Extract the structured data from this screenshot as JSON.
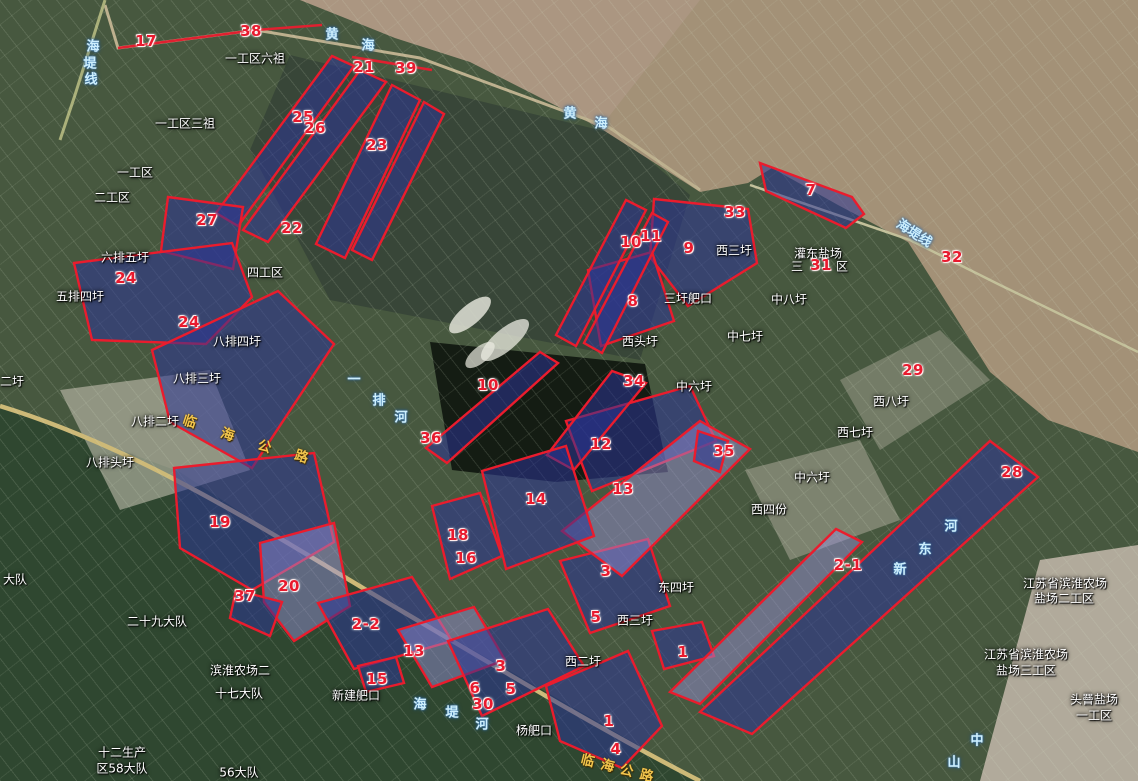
{
  "map_title": "satellite land-parcel annotation map",
  "colors": {
    "marker_red": "#e81a2e",
    "parcel_fill_blue": "#2c3496",
    "parcel_fill_lavender": "#968ed7",
    "parcel_stroke": "#ea1c2d",
    "place_text": "#ffffff",
    "water_text": "#cdeffd",
    "road_text": "#f2c54d",
    "sea": "#a39177",
    "farmland_dark": "#2f4730"
  },
  "markers": [
    {
      "label": "17",
      "x": 146,
      "y": 41
    },
    {
      "label": "38",
      "x": 251,
      "y": 31
    },
    {
      "label": "21",
      "x": 364,
      "y": 67
    },
    {
      "label": "39",
      "x": 406,
      "y": 68
    },
    {
      "label": "25",
      "x": 303,
      "y": 117
    },
    {
      "label": "26",
      "x": 315,
      "y": 128
    },
    {
      "label": "23",
      "x": 377,
      "y": 145
    },
    {
      "label": "27",
      "x": 207,
      "y": 220
    },
    {
      "label": "22",
      "x": 292,
      "y": 228
    },
    {
      "label": "24",
      "x": 126,
      "y": 278
    },
    {
      "label": "24",
      "x": 189,
      "y": 322
    },
    {
      "label": "10",
      "x": 631,
      "y": 242
    },
    {
      "label": "11",
      "x": 651,
      "y": 236
    },
    {
      "label": "9",
      "x": 689,
      "y": 248
    },
    {
      "label": "33",
      "x": 735,
      "y": 212
    },
    {
      "label": "7",
      "x": 811,
      "y": 190
    },
    {
      "label": "31",
      "x": 821,
      "y": 265
    },
    {
      "label": "32",
      "x": 952,
      "y": 257
    },
    {
      "label": "8",
      "x": 633,
      "y": 301
    },
    {
      "label": "34",
      "x": 634,
      "y": 381
    },
    {
      "label": "29",
      "x": 913,
      "y": 370
    },
    {
      "label": "10",
      "x": 488,
      "y": 385
    },
    {
      "label": "36",
      "x": 431,
      "y": 438
    },
    {
      "label": "12",
      "x": 601,
      "y": 444
    },
    {
      "label": "35",
      "x": 724,
      "y": 451
    },
    {
      "label": "13",
      "x": 623,
      "y": 489
    },
    {
      "label": "14",
      "x": 536,
      "y": 499
    },
    {
      "label": "18",
      "x": 458,
      "y": 535
    },
    {
      "label": "16",
      "x": 466,
      "y": 558
    },
    {
      "label": "28",
      "x": 1012,
      "y": 472
    },
    {
      "label": "19",
      "x": 220,
      "y": 522
    },
    {
      "label": "37",
      "x": 245,
      "y": 596
    },
    {
      "label": "20",
      "x": 289,
      "y": 586
    },
    {
      "label": "2-2",
      "x": 366,
      "y": 624
    },
    {
      "label": "13",
      "x": 414,
      "y": 651
    },
    {
      "label": "15",
      "x": 377,
      "y": 679
    },
    {
      "label": "3",
      "x": 606,
      "y": 571
    },
    {
      "label": "5",
      "x": 596,
      "y": 617
    },
    {
      "label": "3",
      "x": 501,
      "y": 666
    },
    {
      "label": "6",
      "x": 475,
      "y": 688
    },
    {
      "label": "5",
      "x": 511,
      "y": 689
    },
    {
      "label": "30",
      "x": 483,
      "y": 704
    },
    {
      "label": "1",
      "x": 683,
      "y": 652
    },
    {
      "label": "2-1",
      "x": 848,
      "y": 565
    },
    {
      "label": "1",
      "x": 609,
      "y": 721
    },
    {
      "label": "4",
      "x": 616,
      "y": 749
    }
  ],
  "place_labels": [
    {
      "text": "一工区六祖",
      "x": 255,
      "y": 58
    },
    {
      "text": "一工区三祖",
      "x": 185,
      "y": 123
    },
    {
      "text": "一工区",
      "x": 135,
      "y": 172
    },
    {
      "text": "二工区",
      "x": 112,
      "y": 197
    },
    {
      "text": "四工区",
      "x": 265,
      "y": 272
    },
    {
      "text": "六排五圩",
      "x": 125,
      "y": 257
    },
    {
      "text": "五排四圩",
      "x": 80,
      "y": 296
    },
    {
      "text": "八排四圩",
      "x": 237,
      "y": 341
    },
    {
      "text": "八排三圩",
      "x": 197,
      "y": 378
    },
    {
      "text": "八排二圩",
      "x": 155,
      "y": 421
    },
    {
      "text": "八排头圩",
      "x": 110,
      "y": 462
    },
    {
      "text": "二圩",
      "x": 12,
      "y": 381
    },
    {
      "text": "大队",
      "x": 15,
      "y": 579
    },
    {
      "text": "二十九大队",
      "x": 157,
      "y": 621
    },
    {
      "text": "滨淮农场二",
      "x": 240,
      "y": 670
    },
    {
      "text": "十七大队",
      "x": 239,
      "y": 693
    },
    {
      "text": "新建舥口",
      "x": 356,
      "y": 695
    },
    {
      "text": "56大队",
      "x": 239,
      "y": 772
    },
    {
      "text": "十二生产",
      "x": 122,
      "y": 752
    },
    {
      "text": "区58大队",
      "x": 122,
      "y": 768
    },
    {
      "text": "西三圩",
      "x": 734,
      "y": 250
    },
    {
      "text": "三圩舥口",
      "x": 688,
      "y": 298
    },
    {
      "text": "西头圩",
      "x": 640,
      "y": 341
    },
    {
      "text": "中八圩",
      "x": 789,
      "y": 299
    },
    {
      "text": "中七圩",
      "x": 745,
      "y": 336
    },
    {
      "text": "中六圩",
      "x": 694,
      "y": 386
    },
    {
      "text": "灌东盐场",
      "x": 818,
      "y": 253
    },
    {
      "text": "三",
      "x": 797,
      "y": 266
    },
    {
      "text": "区",
      "x": 842,
      "y": 266
    },
    {
      "text": "中六圩",
      "x": 812,
      "y": 477
    },
    {
      "text": "西四份",
      "x": 769,
      "y": 509
    },
    {
      "text": "西七圩",
      "x": 855,
      "y": 432
    },
    {
      "text": "西八圩",
      "x": 891,
      "y": 401
    },
    {
      "text": "东四圩",
      "x": 676,
      "y": 587
    },
    {
      "text": "西三圩",
      "x": 635,
      "y": 620
    },
    {
      "text": "西二圩",
      "x": 583,
      "y": 661
    },
    {
      "text": "杨舥口",
      "x": 534,
      "y": 730
    },
    {
      "text": "江苏省滨淮农场",
      "x": 1065,
      "y": 583
    },
    {
      "text": "盐场二工区",
      "x": 1064,
      "y": 598
    },
    {
      "text": "江苏省滨淮农场",
      "x": 1026,
      "y": 654
    },
    {
      "text": "盐场三工区",
      "x": 1026,
      "y": 670
    },
    {
      "text": "头罾盐场",
      "x": 1094,
      "y": 699
    },
    {
      "text": "一工区",
      "x": 1094,
      "y": 715
    }
  ],
  "water_labels": [
    {
      "text": "黄海",
      "chars": [
        {
          "c": "黄",
          "x": 332,
          "y": 33
        },
        {
          "c": "海",
          "x": 368,
          "y": 44
        }
      ]
    },
    {
      "text": "黄海",
      "chars": [
        {
          "c": "黄",
          "x": 570,
          "y": 112
        },
        {
          "c": "海",
          "x": 601,
          "y": 122
        }
      ]
    },
    {
      "text": "海堤线",
      "chars": [
        {
          "c": "海",
          "x": 93,
          "y": 45
        },
        {
          "c": "堤",
          "x": 90,
          "y": 62
        },
        {
          "c": "线",
          "x": 91,
          "y": 78
        }
      ]
    },
    {
      "text": "海堤线",
      "x": 915,
      "y": 232,
      "rot": 33
    },
    {
      "text": "一排河",
      "chars": [
        {
          "c": "一",
          "x": 354,
          "y": 378
        },
        {
          "c": "排",
          "x": 379,
          "y": 399
        },
        {
          "c": "河",
          "x": 401,
          "y": 416
        }
      ]
    },
    {
      "text": "海堤河",
      "chars": [
        {
          "c": "海",
          "x": 420,
          "y": 703
        },
        {
          "c": "堤",
          "x": 452,
          "y": 711
        },
        {
          "c": "河",
          "x": 482,
          "y": 723
        }
      ]
    },
    {
      "text": "新东河",
      "chars": [
        {
          "c": "河",
          "x": 951,
          "y": 525
        },
        {
          "c": "东",
          "x": 925,
          "y": 548
        },
        {
          "c": "新",
          "x": 900,
          "y": 568
        }
      ]
    },
    {
      "text": "中山",
      "chars": [
        {
          "c": "中",
          "x": 977,
          "y": 739
        },
        {
          "c": "山",
          "x": 954,
          "y": 761
        }
      ]
    }
  ],
  "road_labels": [
    {
      "text": "临海公路",
      "chars": [
        {
          "c": "临",
          "x": 190,
          "y": 420
        },
        {
          "c": "海",
          "x": 228,
          "y": 433
        },
        {
          "c": "公",
          "x": 265,
          "y": 445
        },
        {
          "c": "路",
          "x": 302,
          "y": 455
        }
      ],
      "rot": 18
    },
    {
      "text": "临海公路",
      "chars": [
        {
          "c": "临",
          "x": 588,
          "y": 759
        },
        {
          "c": "海",
          "x": 608,
          "y": 764
        },
        {
          "c": "公",
          "x": 627,
          "y": 769
        },
        {
          "c": "路",
          "x": 647,
          "y": 774
        }
      ],
      "rot": 14
    }
  ],
  "parcels": [
    {
      "points": "332,56 354,66 238,226 216,213",
      "tint": "pd"
    },
    {
      "points": "360,70 386,82 268,242 243,230",
      "tint": "pd"
    },
    {
      "points": "392,85 420,100 345,258 316,244",
      "tint": "pd"
    },
    {
      "points": "424,102 444,114 372,260 352,250",
      "tint": "pd"
    },
    {
      "points": "168,197 243,207 233,269 161,251",
      "tint": "pd"
    },
    {
      "points": "74,263 232,243 252,297 206,344 92,340",
      "tint": "pd"
    },
    {
      "points": "152,350 278,291 334,344 252,468 170,422",
      "tint": "pd"
    },
    {
      "points": "174,468 314,453 334,542 252,590 180,548",
      "tint": "pd"
    },
    {
      "points": "260,543 334,523 350,606 294,641 264,602",
      "tint": "pl"
    },
    {
      "points": "236,590 282,602 270,636 230,618",
      "tint": "pd"
    },
    {
      "points": "318,603 412,577 452,641 354,669",
      "tint": "pd"
    },
    {
      "points": "398,630 474,607 505,660 432,687",
      "tint": "pl"
    },
    {
      "points": "358,666 396,657 404,683 366,692",
      "tint": "pd"
    },
    {
      "points": "448,641 548,609 584,666 482,716",
      "tint": "pd"
    },
    {
      "points": "560,561 648,539 670,606 590,633",
      "tint": "pd"
    },
    {
      "points": "546,686 628,651 662,726 622,768 560,741",
      "tint": "pd"
    },
    {
      "points": "652,631 702,622 714,656 664,669",
      "tint": "pd"
    },
    {
      "points": "700,712 752,734 1038,477 990,441",
      "tint": "pd"
    },
    {
      "points": "670,692 700,704 862,542 836,529",
      "tint": "pl"
    },
    {
      "points": "760,163 852,197 864,214 846,228 766,191",
      "tint": "pd"
    },
    {
      "points": "654,199 748,209 757,263 688,306 650,257",
      "tint": "pd"
    },
    {
      "points": "588,270 652,252 674,321 601,346",
      "tint": "pd"
    },
    {
      "points": "626,200 646,210 576,346 556,335",
      "tint": "pd"
    },
    {
      "points": "652,213 668,222 602,353 584,343",
      "tint": "pd"
    },
    {
      "points": "540,352 558,363 447,463 426,448",
      "tint": "pd"
    },
    {
      "points": "566,421 690,386 716,441 592,491",
      "tint": "pd"
    },
    {
      "points": "612,371 646,383 574,470 547,455",
      "tint": "pd"
    },
    {
      "points": "700,421 750,449 622,576 562,531",
      "tint": "pl"
    },
    {
      "points": "482,471 566,446 594,536 506,569",
      "tint": "pd"
    },
    {
      "points": "432,506 480,493 502,556 450,579",
      "tint": "pd"
    },
    {
      "points": "698,431 728,441 720,472 694,461",
      "tint": "pd"
    }
  ],
  "red_lines": [
    {
      "points": "118,48 256,30 322,25"
    },
    {
      "points": "352,57 432,70"
    }
  ]
}
